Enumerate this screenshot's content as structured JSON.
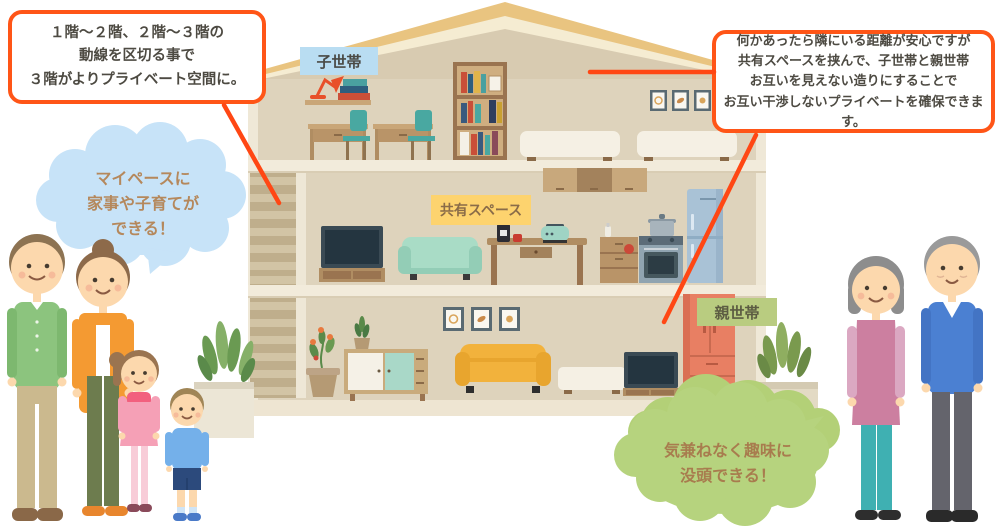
{
  "callouts": {
    "stairs": {
      "lines": [
        "１階～２階、２階～３階の",
        "動線を区切る事で",
        "３階がよりプライベート空間に。"
      ]
    },
    "privacy": {
      "lines": [
        "何かあったら隣にいる距離が安心ですが",
        "共有スペースを挟んで、子世帯と親世帯",
        "お互いを見えない造りにすることで",
        "お互い干渉しないプライベートを確保できます。"
      ]
    }
  },
  "speech_bubbles": {
    "family": {
      "lines": [
        "マイペースに",
        "家事や子育てが",
        "できる！"
      ],
      "bg": "#c7e3f8",
      "text_color": "#b5885c"
    },
    "grandparents": {
      "lines": [
        "気兼ねなく趣味に",
        "没頭できる！"
      ],
      "bg": "#b6d37e",
      "text_color": "#a87c4e"
    }
  },
  "floor_labels": {
    "child": {
      "text": "子世帯",
      "bg": "#b9ddf2"
    },
    "shared": {
      "text": "共有スペース",
      "bg": "#fdd36e"
    },
    "parent": {
      "text": "親世帯",
      "bg": "#b9cc80"
    }
  },
  "colors": {
    "accent_line": "#ff4714",
    "callout_border": "#ff5517",
    "roof": "#e9c480",
    "wall": "#ded3bc",
    "wardrobe": "#e87f63",
    "yellow_sofa": "#f2b23c",
    "mint_sofa": "#a9dcc6"
  }
}
